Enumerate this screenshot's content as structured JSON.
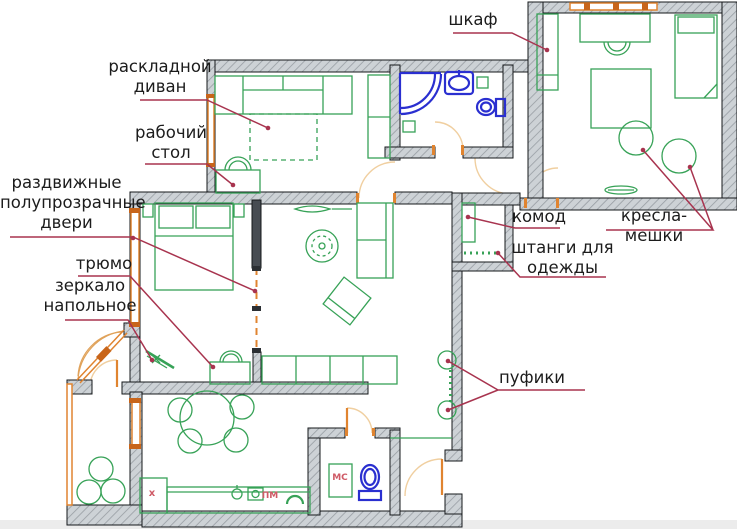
{
  "title": "apartment-floor-plan",
  "colors": {
    "furniture_green": "#37a257",
    "fixture_blue": "#2a2fd0",
    "window_orange": "#e08430",
    "door_arc_peach": "#f0cfa0",
    "leader_crimson": "#a8344f",
    "wall_fill": "#cdd2d6",
    "wall_hatch": "#979da3",
    "label_text": "#1c1c1c",
    "mini_label_red": "#cf5a66"
  },
  "labels": [
    {
      "id": "wardrobe",
      "text": "шкаф"
    },
    {
      "id": "sofa",
      "text": "раскладной\nдиван"
    },
    {
      "id": "desk",
      "text": "рабочий\nстол"
    },
    {
      "id": "doors",
      "text": "раздвижные\nполупрозрачные\nдвери"
    },
    {
      "id": "trumeau",
      "text": "трюмо"
    },
    {
      "id": "mirror",
      "text": "зеркало\nнапольное"
    },
    {
      "id": "komod",
      "text": "комод"
    },
    {
      "id": "rails",
      "text": "штанги для\nодежды"
    },
    {
      "id": "beanbags",
      "text": "кресла-мешки"
    },
    {
      "id": "poufs",
      "text": "пуфики"
    }
  ],
  "mini_labels": [
    {
      "id": "kitchen-x",
      "text": "x"
    },
    {
      "id": "dishwasher",
      "text": "ПМ"
    },
    {
      "id": "washing-machine",
      "text": "МС"
    }
  ]
}
